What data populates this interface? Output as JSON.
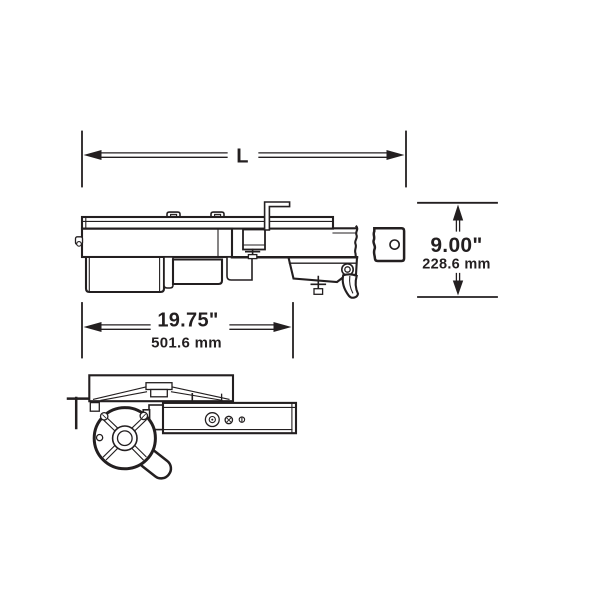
{
  "diagram": {
    "kind": "engineering-line-drawing",
    "views": {
      "side_view": "garage-door-opener side elevation",
      "bottom_view": "garage-door-opener plan view"
    },
    "dimensions": {
      "overall_length": {
        "label": "L"
      },
      "height": {
        "inches": "9.00\"",
        "millimeters": "228.6 mm"
      },
      "head_length": {
        "inches": "19.75\"",
        "millimeters": "501.6 mm"
      }
    },
    "colors": {
      "line": "#231f20",
      "background": "#ffffff"
    }
  }
}
